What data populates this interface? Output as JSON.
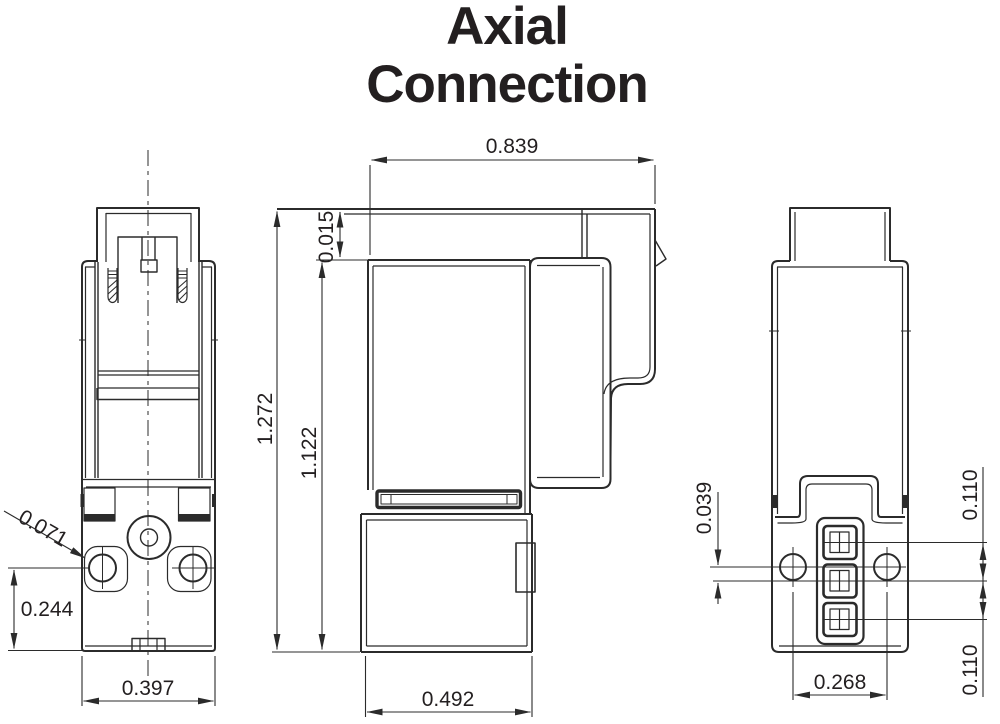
{
  "title": {
    "line1": "Axial",
    "line2": "Connection"
  },
  "colors": {
    "line": "#2b2b2b",
    "text": "#231f20",
    "background": "#ffffff"
  },
  "dimensions": {
    "front_hole_diameter": "0.071",
    "front_hole_height": "0.244",
    "front_width": "0.397",
    "side_top_width": "0.839",
    "side_top_gap": "0.015",
    "side_overall_height": "1.272",
    "side_body_height": "1.122",
    "side_base_width": "0.492",
    "rear_hole_to_pin_offset": "0.039",
    "rear_pin_pitch_upper": "0.110",
    "rear_pin_pitch_lower": "0.110",
    "rear_hole_spacing": "0.268"
  }
}
